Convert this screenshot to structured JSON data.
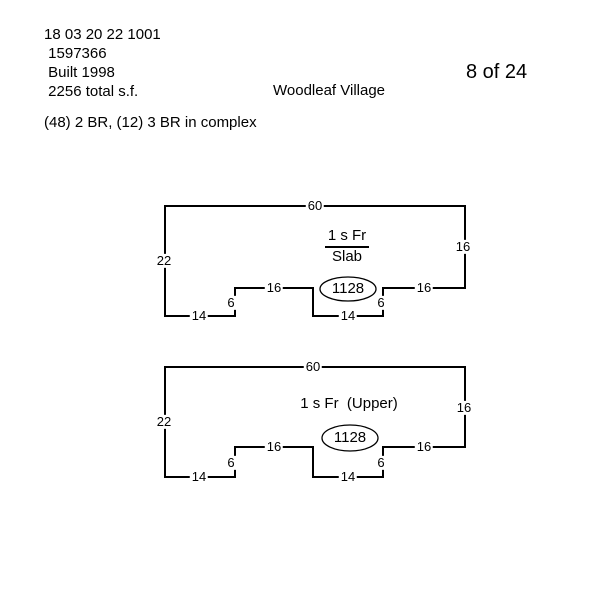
{
  "colors": {
    "ink": "#000000",
    "paper": "#ffffff"
  },
  "header": {
    "parcel_id": "18 03 20 22 1001",
    "account_number": " 1597366",
    "year_built": " Built 1998",
    "total_sf": " 2256 total s.f.",
    "complex_info": "(48) 2 BR, (12) 3 BR in complex",
    "community_name": "Woodleaf Village",
    "page_indicator": "8 of 24"
  },
  "sketches": [
    {
      "story_label": "1 s Fr",
      "foundation_label": "Slab",
      "area": "1128",
      "dims": {
        "top": "60",
        "right": "16",
        "left": "22",
        "bottom_left": "14",
        "step_left": "6",
        "shelf_left": "16",
        "bottom_middle": "14",
        "step_right": "6",
        "shelf_right": "16"
      }
    },
    {
      "story_label": "1 s Fr  (Upper)",
      "area": "1128",
      "dims": {
        "top": "60",
        "right": "16",
        "left": "22",
        "bottom_left": "14",
        "step_left": "6",
        "shelf_left": "16",
        "bottom_middle": "14",
        "step_right": "6",
        "shelf_right": "16"
      }
    }
  ]
}
